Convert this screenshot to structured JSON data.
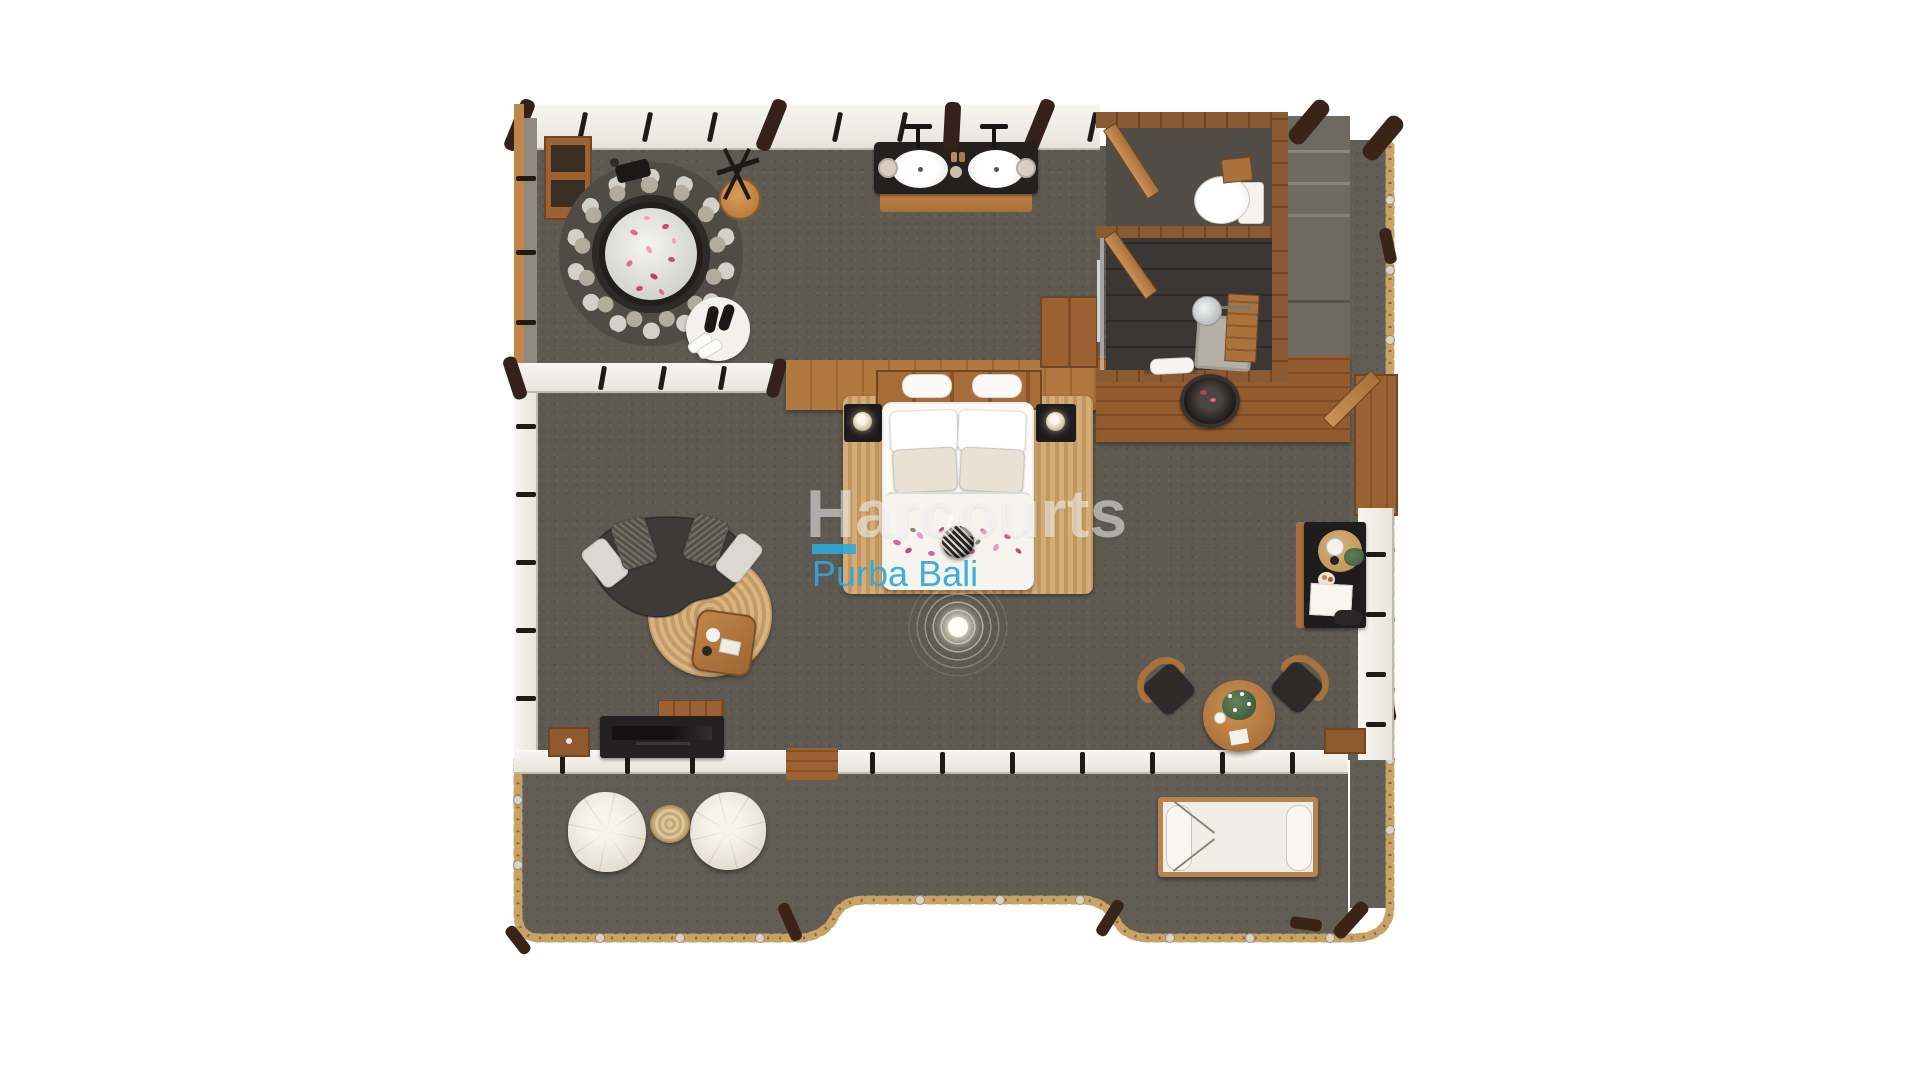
{
  "watermark": {
    "brand": "Harcourts",
    "sub_brand": "Purba Bali",
    "brand_color": "rgba(255,255,255,0.52)",
    "sub_brand_color": "#2FA8D8"
  },
  "scene": {
    "description": "Top-down 3D rendered floor plan of a one-bedroom villa suite with spa, bathroom, bedroom-living area and outdoor deck",
    "background_color": "#ffffff",
    "carpet_color": "#5e5a52",
    "deck_color": "#625e55",
    "wood_color": "#b0793f",
    "dark_wood_color": "#33211a",
    "rope_railing_color": "#c8a365",
    "wall_color": "#f4f1ea",
    "rooms": [
      "spa-area",
      "wc-room",
      "shower-room",
      "bedroom-living-area",
      "outdoor-deck",
      "entry-steps"
    ],
    "furniture": [
      "round-hot-tub-with-pebble-ring",
      "towel-stand-with-stool",
      "bath-mat-with-slippers",
      "storage-shelf",
      "double-sink-vanity",
      "toilet",
      "rain-shower",
      "shower-bench",
      "outdoor-basin",
      "double-bed",
      "nightstand-left",
      "nightstand-right",
      "pendant-lamp",
      "ceiling-light",
      "curved-sofa",
      "round-jute-rug",
      "coffee-table",
      "tv-console",
      "storage-box",
      "wardrobe",
      "minibar-desk",
      "dining-table",
      "dining-chair-left",
      "dining-chair-right",
      "pouffe-left",
      "pouffe-right",
      "stump-side-table",
      "sun-lounger",
      "deck-step-bench"
    ]
  }
}
